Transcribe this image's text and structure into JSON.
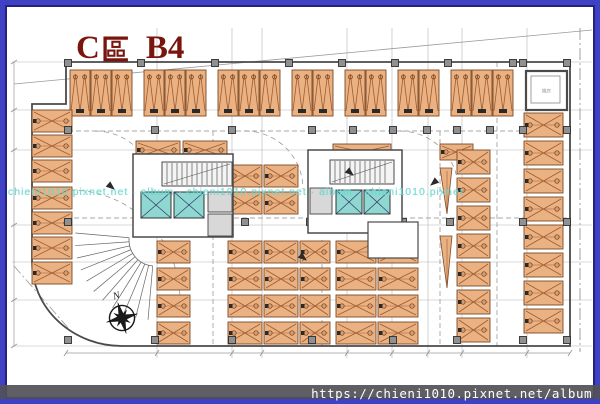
{
  "title": {
    "text": "C區 B4",
    "prefix": "C",
    "suffix": "B4"
  },
  "watermark": {
    "text": "chieni1010.pixnet.net · album · chieni1010.pixnet.net · album · chieni1010.pixnet"
  },
  "footer": {
    "url": "https://chieni1010.pixnet.net/album"
  },
  "compass": {
    "label": "N"
  },
  "colors": {
    "frame_outer": "#3e41c3",
    "frame_inner": "#23237e",
    "title_red": "#7a150e",
    "wall": "#4a4a4a",
    "grid": "#b5b5b5",
    "boundary": "#9a9a9a",
    "dash": "#8a8a8a",
    "stall_fill": "#eab183",
    "stall_line": "#7d4a26",
    "stall_zig": "#a05c2e",
    "stall_mark": "#2a2a2a",
    "elevator_fill": "#8fd8d2",
    "column_fill": "#909090",
    "black": "#1a1a1a",
    "footer_bg": "#52525a",
    "watermark_cyan": "#69d6d0"
  },
  "plan": {
    "grid": {
      "vertical": [
        157,
        232,
        262,
        347,
        392,
        428,
        462,
        527
      ],
      "horizontal": [
        62,
        110,
        150,
        225,
        262,
        300,
        346
      ],
      "x_range": [
        12,
        592
      ],
      "y_range": [
        28,
        358
      ]
    },
    "boundary": {
      "diagonal": [
        14,
        84,
        592,
        30
      ],
      "corner_diagonal": [
        14,
        266,
        70,
        330
      ],
      "right_dashdot_x": 580
    },
    "outline": "M 66 62 L 570 62 L 570 346 L 122 346 A 90 84 0 0 1 32 262 L 32 104 L 66 104 Z",
    "dims": {
      "bottom": {
        "y": 353,
        "x1": 66,
        "x2": 570,
        "ticks": [
          66,
          157,
          232,
          262,
          347,
          392,
          428,
          462,
          527,
          570
        ]
      },
      "left": {
        "x": 14,
        "y1": 62,
        "y2": 346,
        "ticks": [
          62,
          110,
          150,
          225,
          300,
          346
        ]
      }
    },
    "aisle_dashed": [
      [
        68,
        131,
        525,
        131
      ],
      [
        66,
        218,
        570,
        218
      ],
      [
        213,
        131,
        213,
        346
      ],
      [
        497,
        62,
        497,
        346
      ],
      [
        440,
        131,
        440,
        346
      ],
      [
        322,
        240,
        322,
        346
      ]
    ],
    "turning_arcs": [
      "M 95 131 A 60 60 0 0 1 155 191",
      "M 245 131 A 58 58 0 0 1 303 189",
      "M 400 131 A 58 58 0 0 1 458 189",
      "M 70 190 A 110 110 0 0 1 180 300"
    ],
    "top_row": {
      "y": 70,
      "w": 20,
      "h": 46,
      "step": 21,
      "groups": [
        {
          "x": 70,
          "n": 3
        },
        {
          "x": 144,
          "n": 3
        },
        {
          "x": 218,
          "n": 3
        },
        {
          "x": 292,
          "n": 2
        },
        {
          "x": 345,
          "n": 2
        },
        {
          "x": 398,
          "n": 2
        },
        {
          "x": 451,
          "n": 3
        }
      ]
    },
    "h_groups": [
      {
        "x": 32,
        "y": 110,
        "w": 40,
        "h": 22,
        "n": 3,
        "g": 3
      },
      {
        "x": 32,
        "y": 187,
        "w": 40,
        "h": 22,
        "n": 4,
        "g": 3
      },
      {
        "x": 136,
        "y": 141,
        "w": 44,
        "h": 18,
        "n": 1,
        "g": 0
      },
      {
        "x": 183,
        "y": 141,
        "w": 44,
        "h": 18,
        "n": 1,
        "g": 0
      },
      {
        "x": 333,
        "y": 144,
        "w": 58,
        "h": 16,
        "n": 1,
        "g": 0
      },
      {
        "x": 440,
        "y": 144,
        "w": 33,
        "h": 16,
        "n": 1,
        "g": 0
      },
      {
        "x": 228,
        "y": 165,
        "w": 34,
        "h": 22,
        "n": 2,
        "g": 5
      },
      {
        "x": 264,
        "y": 165,
        "w": 34,
        "h": 22,
        "n": 2,
        "g": 5
      },
      {
        "x": 157,
        "y": 241,
        "w": 33,
        "h": 22,
        "n": 4,
        "g": 5
      },
      {
        "x": 228,
        "y": 241,
        "w": 34,
        "h": 22,
        "n": 4,
        "g": 5
      },
      {
        "x": 264,
        "y": 241,
        "w": 34,
        "h": 22,
        "n": 4,
        "g": 5
      },
      {
        "x": 300,
        "y": 241,
        "w": 30,
        "h": 22,
        "n": 4,
        "g": 5
      },
      {
        "x": 336,
        "y": 241,
        "w": 40,
        "h": 22,
        "n": 4,
        "g": 5
      },
      {
        "x": 378,
        "y": 241,
        "w": 40,
        "h": 22,
        "n": 4,
        "g": 5
      },
      {
        "x": 457,
        "y": 150,
        "w": 33,
        "h": 24,
        "n": 7,
        "g": 4
      },
      {
        "x": 524,
        "y": 113,
        "w": 39,
        "h": 24,
        "n": 8,
        "g": 4
      }
    ],
    "ramp_triangles": [
      [
        [
          440,
          168
        ],
        [
          452,
          168
        ],
        [
          447,
          214
        ]
      ],
      [
        [
          440,
          236
        ],
        [
          452,
          236
        ],
        [
          447,
          288
        ]
      ]
    ],
    "columns": [
      [
        68,
        63
      ],
      [
        141,
        63
      ],
      [
        215,
        63
      ],
      [
        289,
        63
      ],
      [
        342,
        63
      ],
      [
        395,
        63
      ],
      [
        448,
        63
      ],
      [
        513,
        63
      ],
      [
        523,
        63
      ],
      [
        567,
        63
      ],
      [
        68,
        130
      ],
      [
        155,
        130
      ],
      [
        232,
        130
      ],
      [
        312,
        130
      ],
      [
        353,
        130
      ],
      [
        393,
        130
      ],
      [
        427,
        130
      ],
      [
        457,
        130
      ],
      [
        490,
        130
      ],
      [
        523,
        130
      ],
      [
        567,
        130
      ],
      [
        68,
        222
      ],
      [
        143,
        222
      ],
      [
        245,
        222
      ],
      [
        310,
        222
      ],
      [
        403,
        222
      ],
      [
        450,
        222
      ],
      [
        523,
        222
      ],
      [
        567,
        222
      ],
      [
        68,
        340
      ],
      [
        155,
        340
      ],
      [
        232,
        340
      ],
      [
        312,
        340
      ],
      [
        393,
        340
      ],
      [
        457,
        340
      ],
      [
        523,
        340
      ],
      [
        567,
        340
      ]
    ],
    "cores": [
      {
        "rect": [
          133,
          154,
          100,
          83
        ],
        "stair": [
          162,
          162,
          70,
          24
        ],
        "elev": [
          [
            141,
            192,
            30,
            26
          ],
          [
            174,
            192,
            30,
            26
          ]
        ],
        "shafts": [
          [
            208,
            192,
            24,
            20
          ],
          [
            208,
            214,
            24,
            22
          ]
        ]
      },
      {
        "rect": [
          308,
          150,
          94,
          83
        ],
        "stair": [
          330,
          160,
          64,
          24
        ],
        "elev": [
          [
            336,
            190,
            26,
            24
          ],
          [
            364,
            190,
            26,
            24
          ]
        ],
        "shafts": [
          [
            310,
            188,
            22,
            26
          ]
        ],
        "annex": [
          368,
          222,
          50,
          36
        ]
      }
    ],
    "machine_room": {
      "x": 526,
      "y": 71,
      "w": 41,
      "h": 39,
      "label": "機房"
    },
    "stair_fan": {
      "cx": 155,
      "cy": 240,
      "r1": 26,
      "r2": 80,
      "a1": 95,
      "a2": 185,
      "step": 9
    },
    "compass": {
      "cx": 122,
      "cy": 318,
      "rot": -15
    },
    "flow_arrows": [
      [
        108,
        184,
        40
      ],
      [
        437,
        180,
        140
      ],
      [
        347,
        170,
        40
      ],
      [
        300,
        255,
        40
      ]
    ]
  }
}
